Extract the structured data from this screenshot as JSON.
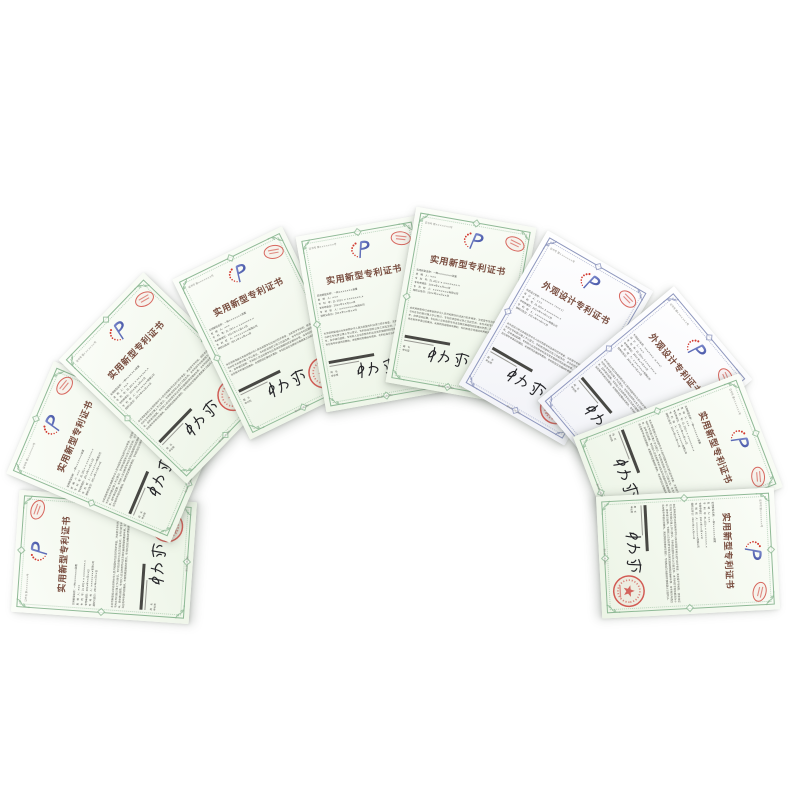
{
  "page": {
    "background": "#ffffff",
    "description": "fan of Chinese patent certificates on white background"
  },
  "colors": {
    "utility_border": "#8fb996",
    "utility_paper_light": "#fbfdf8",
    "utility_paper_dark": "#ecf4e6",
    "design_border": "#8d96bd",
    "design_paper_light": "#ffffff",
    "design_paper_dark": "#f1f2f7",
    "title_text": "#7a4f41",
    "seal_red": "#cf4b44",
    "stamp_red": "#d4574e",
    "logo_blue_dark": "#2c3c94",
    "logo_blue_light": "#8a97d6",
    "logo_dot_red": "#d23a30",
    "signature_ink": "#26262a"
  },
  "certificates": {
    "shared": {
      "cert_no": "证书号 第×××××××号",
      "issuer_labels": "局　长\n申长雨",
      "signature": "申长雨",
      "page_note": "第1页（共2页）",
      "utility": {
        "title": "实用新型专利证书",
        "fields": "实用新型名称：一种×××××××装置\n发　明　人：×××\n专　利　号：ZL 201× × ×××××××.×\n专利申请日：201×年××月××日\n专　利　权　人：××××××××有限公司\n授权公告日：201×年××月××日",
        "body": "本实用新型经过本局依照中华人民共和国专利法进行初步审查，决定授予专利权，颁发本证书并在专利登记簿上予以登记。专利权自授权公告之日起生效。本专利的专利权期限为十年，自申请日起算。专利权人应当依照专利法及其实施细则规定缴纳年费，本专利的年费应当在每年申请日前缴纳。未按照规定缴纳年费的，专利权自应当缴纳年费期满之日起终止。"
      },
      "design": {
        "title": "外观设计专利证书",
        "fields": "外观设计名称：×××××××（××××）\n设　计　人：×××\n专　利　号：ZL 201× 3 ×××××××.×\n专利申请日：201×年××月××日\n专　利　权　人：××××××××有限公司\n授权公告日：201×年××月××日",
        "body": "本外观设计经过本局依照中华人民共和国专利法进行初步审查，决定授予专利权，颁发本证书并在专利登记簿上予以登记。专利权自授权公告之日起生效。本专利的专利权期限为十年，自申请日起算。专利权人应当依照专利法及其实施细则规定缴纳年费，本专利的年费应当在每年申请日前缴纳。未按照规定缴纳年费的，专利权自应当缴纳年费期满之日起终止。"
      },
      "seal_label": "中华人民共和国国家知识产权局",
      "oval_stamp_label": "专利证书专用章"
    },
    "items": [
      {
        "variant": "utility",
        "left": 43,
        "top": 468,
        "rotation_deg": -86,
        "z": 1
      },
      {
        "variant": "utility",
        "left": 51,
        "top": 363,
        "rotation_deg": -67,
        "z": 2
      },
      {
        "variant": "utility",
        "left": 104,
        "top": 289,
        "rotation_deg": -46,
        "z": 3
      },
      {
        "variant": "utility",
        "left": 205,
        "top": 244,
        "rotation_deg": -26,
        "z": 4
      },
      {
        "variant": "utility",
        "left": 310,
        "top": 225,
        "rotation_deg": -10,
        "z": 5
      },
      {
        "variant": "utility",
        "left": 400,
        "top": 216,
        "rotation_deg": 10,
        "z": 6
      },
      {
        "variant": "design",
        "left": 495,
        "top": 249,
        "rotation_deg": 30,
        "z": 7
      },
      {
        "variant": "design",
        "left": 584,
        "top": 301,
        "rotation_deg": 50,
        "z": 8
      },
      {
        "variant": "utility",
        "left": 617,
        "top": 373,
        "rotation_deg": 69,
        "z": 9
      },
      {
        "variant": "utility",
        "left": 627,
        "top": 464,
        "rotation_deg": 87,
        "z": 10
      }
    ]
  }
}
